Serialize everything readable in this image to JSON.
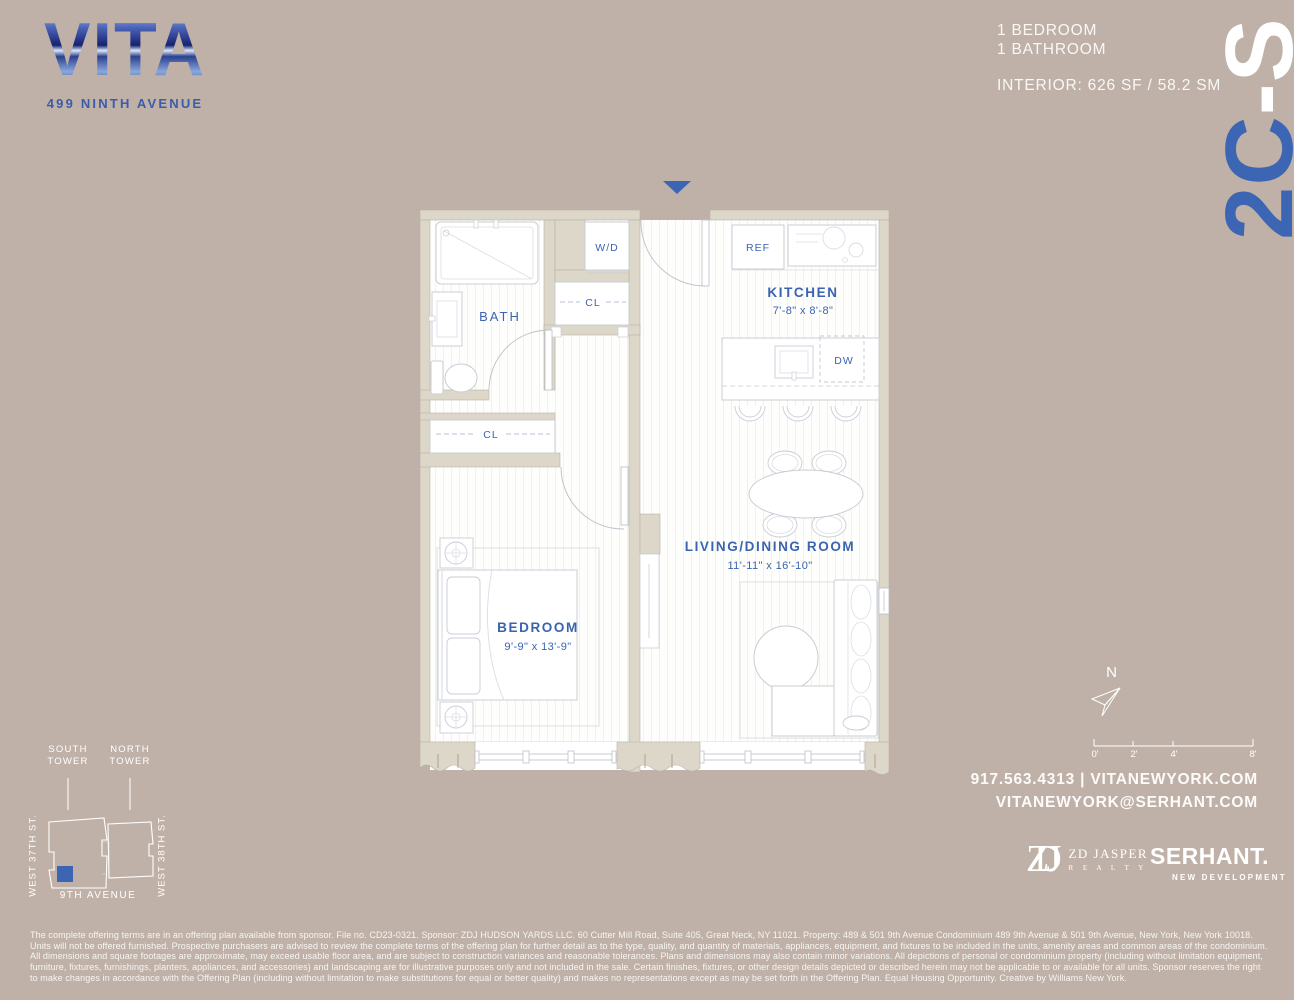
{
  "colors": {
    "background": "#c0b1a8",
    "accent_blue": "#3c65b4",
    "label_blue": "#3a64b0",
    "white": "#ffffff"
  },
  "logo": {
    "name": "VITA",
    "address": "499 NINTH AVENUE"
  },
  "unit_info": {
    "bedroom": "1 BEDROOM",
    "bathroom": "1 BATHROOM",
    "interior": "INTERIOR: 626 SF / 58.2 SM"
  },
  "unit_number": {
    "prefix": "2C",
    "suffix": "-S"
  },
  "floorplan": {
    "rooms": {
      "bath": {
        "name": "BATH"
      },
      "wd": {
        "name": "W/D"
      },
      "closet1": {
        "name": "CL"
      },
      "closet2": {
        "name": "CL"
      },
      "kitchen": {
        "name": "KITCHEN",
        "dims": "7'-8\" x 8'-8\""
      },
      "living": {
        "name": "LIVING/DINING ROOM",
        "dims": "11'-11\" x 16'-10\""
      },
      "bedroom": {
        "name": "BEDROOM",
        "dims": "9'-9\" x 13'-9\""
      },
      "ref": {
        "name": "REF"
      },
      "dw": {
        "name": "DW"
      }
    }
  },
  "site_map": {
    "south_tower": "SOUTH\nTOWER",
    "north_tower": "NORTH\nTOWER",
    "west_37": "WEST 37TH ST.",
    "west_38": "WEST 38TH ST.",
    "avenue": "9TH AVENUE"
  },
  "compass": {
    "north": "N"
  },
  "scale_bar": {
    "ticks": [
      "0'",
      "2'",
      "4'",
      "8'"
    ]
  },
  "contact": {
    "phone_site": "917.563.4313 | VITANEWYORK.COM",
    "email": "VITANEWYORK@SERHANT.COM"
  },
  "brokers": {
    "zdj_monogram": "ZDJ",
    "zdj_name": "ZD JASPER",
    "zdj_sub": "R E A L T Y",
    "serhant": "SERHANT.",
    "serhant_sub": "NEW DEVELOPMENT"
  },
  "disclaimer": "The complete offering terms are in an offering plan available from sponsor. File no. CD23-0321. Sponsor: ZDJ HUDSON YARDS LLC. 60 Cutter Mill Road, Suite 405, Great Neck, NY 11021. Property: 489 & 501 9th Avenue Condominium 489 9th Avenue & 501 9th Avenue, New York, New York 10018. Units will not be offered furnished. Prospective purchasers are advised to review the complete terms of the offering plan for further detail as to the type, quality, and quantity of materials, appliances, equipment, and fixtures to be included in the units, amenity areas and common areas of the condominium. All dimensions and square footages are approximate, may exceed usable floor area, and are subject to construction variances and reasonable tolerances. Plans and dimensions may also contain minor variations. All depictions of personal or condominium property (including without limitation equipment, furniture, fixtures, furnishings, planters, appliances, and accessories) and landscaping are for illustrative purposes only and not included in the sale. Certain finishes, fixtures, or other design details depicted or described herein may not be applicable to or available for all units. Sponsor reserves the right to make changes in accordance with the Offering Plan (including without limitation to make substitutions for equal or better quality) and makes no representations except as may be set forth in the Offering Plan. Equal Housing Opportunity. Creative by Williams New York."
}
